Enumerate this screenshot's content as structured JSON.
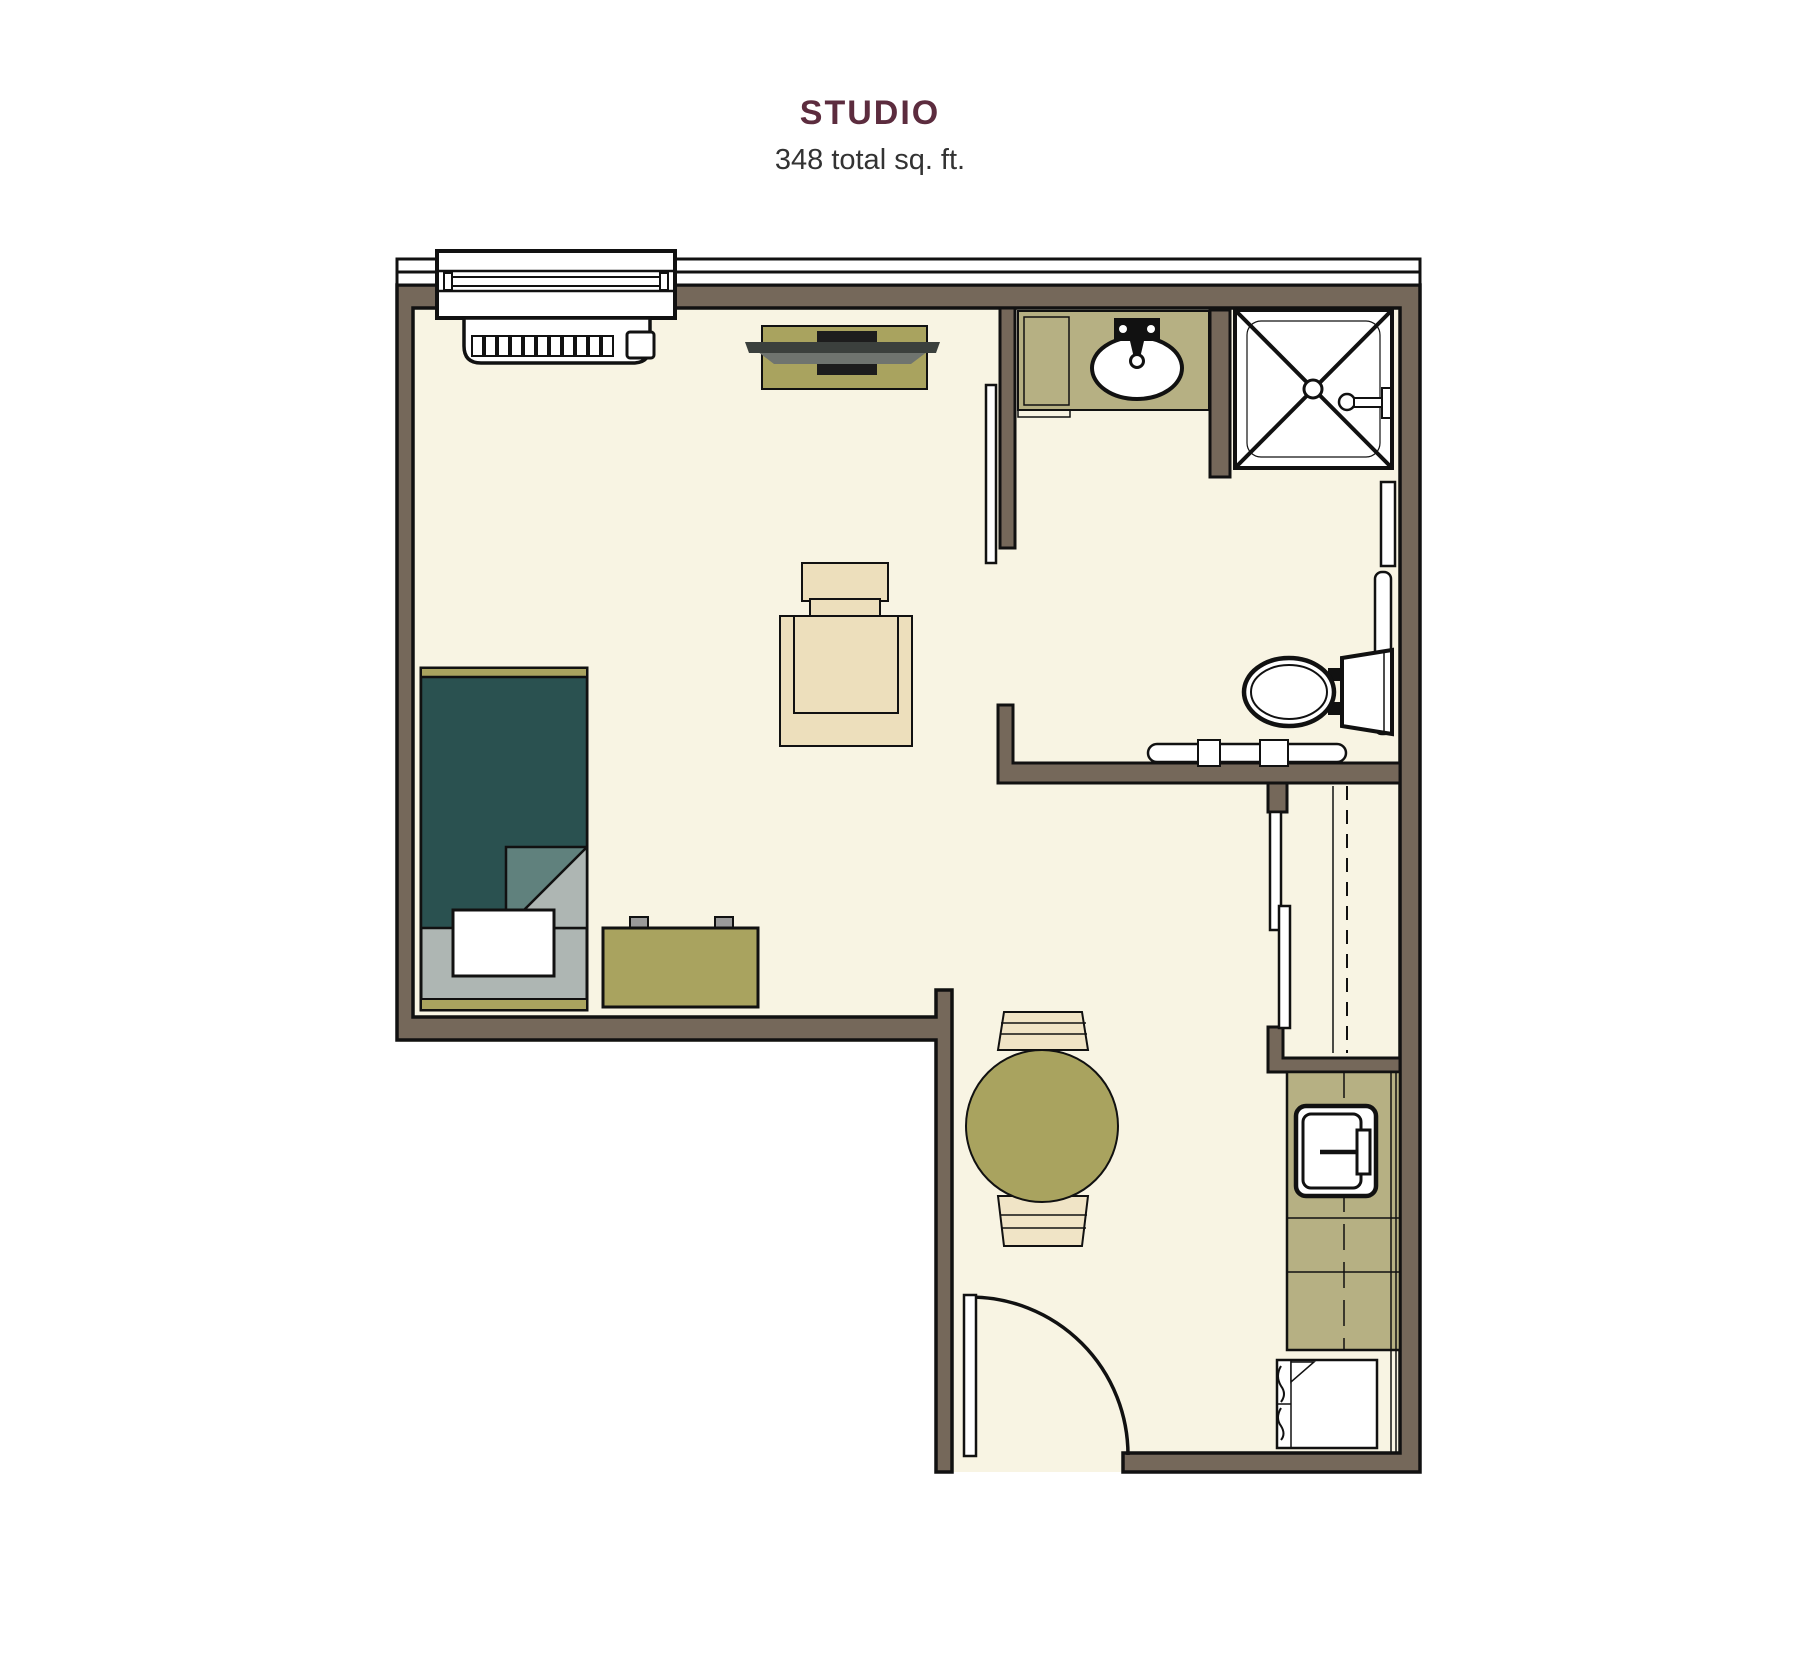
{
  "header": {
    "title": "STUDIO",
    "subtitle": "348 total sq. ft."
  },
  "colors": {
    "wall": "#75685A",
    "floor": "#F8F4E3",
    "ink": "#111111",
    "olive": "#A9A35F",
    "olive_light": "#B6B083",
    "teal": "#2A5150",
    "teal_fold": "#60817D",
    "sheet": "#AEB6B3",
    "tan": "#EDDFBC",
    "chair_tan": "#F0E4C6",
    "tv_dark": "#3B403D",
    "tv_mid": "#6F746F",
    "knob": "#9A9A9A",
    "title": "#5C2C3E",
    "subtitle": "#333333"
  },
  "fixtures": {
    "bed": "twin bed",
    "bench": "dresser bench",
    "armchair": "lounge chair",
    "tv": "tv on media console",
    "dining": "round table with two chairs",
    "vanity": "bathroom vanity with sink",
    "shower": "walk-in shower",
    "toilet": "toilet with grab bars",
    "closet": "closet with sliding doors",
    "kitchenette": "kitchenette counter with sink",
    "refrigerator": "under-counter refrigerator",
    "window": "window with heating unit",
    "entry": "entry door"
  }
}
